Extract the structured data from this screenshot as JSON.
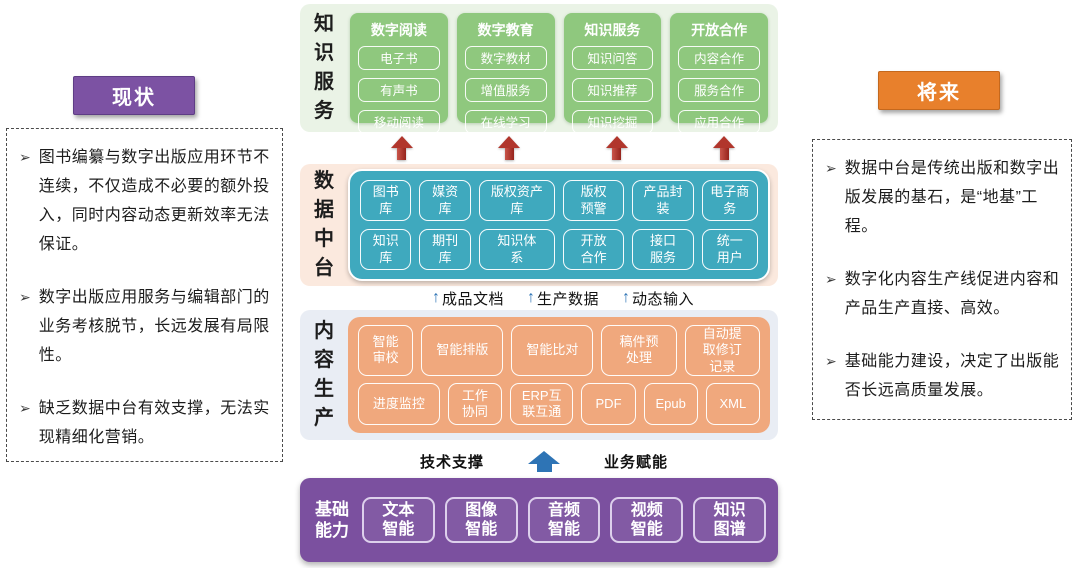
{
  "glyphs": {
    "bullet": "➢",
    "up_arrow": "↑"
  },
  "colors": {
    "status_purple": "#7c52a3",
    "future_orange": "#e8802c",
    "knowledge_green": "#8fc87e",
    "knowledge_bg": "#eaf3e6",
    "platform_teal": "#3fa9be",
    "platform_bg": "#fbe9de",
    "production_orange": "#f0a87d",
    "production_bg": "#e9edf4",
    "base_purple": "#7b509f",
    "arrow_red": "#b1362c",
    "arrow_blue": "#2e74b5"
  },
  "left_panel": {
    "title": "现状",
    "bullets": [
      "图书编纂与数字出版应用环节不连续，不仅造成不必要的额外投入，同时内容动态更新效率无法保证。",
      "数字出版应用服务与编辑部门的业务考核脱节，长远发展有局限性。",
      "缺乏数据中台有效支撑，无法实现精细化营销。"
    ]
  },
  "right_panel": {
    "title": "将来",
    "bullets": [
      "数据中台是传统出版和数字出版发展的基石，是“地基”工程。",
      "数字化内容生产线促进内容和产品生产直接、高效。",
      "基础能力建设，决定了出版能否长远高质量发展。"
    ]
  },
  "knowledge_service": {
    "label": "知识服务",
    "columns": [
      {
        "title": "数字阅读",
        "items": [
          "电子书",
          "有声书",
          "移动阅读"
        ]
      },
      {
        "title": "数字教育",
        "items": [
          "数字教材",
          "增值服务",
          "在线学习"
        ]
      },
      {
        "title": "知识服务",
        "items": [
          "知识问答",
          "知识推荐",
          "知识挖掘"
        ]
      },
      {
        "title": "开放合作",
        "items": [
          "内容合作",
          "服务合作",
          "应用合作"
        ]
      }
    ]
  },
  "data_platform": {
    "label": "数据中台",
    "rows": [
      [
        "图书库",
        "媒资库",
        "版权资产库",
        "版权预警",
        "产品封装",
        "电子商务"
      ],
      [
        "知识库",
        "期刊库",
        "知识体系",
        "开放合作",
        "接口服务",
        "统一用户"
      ]
    ]
  },
  "flow_labels": [
    "成品文档",
    "生产数据",
    "动态输入"
  ],
  "content_production": {
    "label": "内容生产",
    "rows": [
      [
        "智能审校",
        "智能排版",
        "智能比对",
        "稿件预处理",
        "自动提取修订记录"
      ],
      [
        "进度监控",
        "工作协同",
        "ERP互联互通",
        "PDF",
        "Epub",
        "XML"
      ]
    ]
  },
  "support_labels": {
    "left": "技术支撑",
    "right": "业务赋能"
  },
  "base_capability": {
    "label": "基础能力",
    "items": [
      "文本智能",
      "图像智能",
      "音频智能",
      "视频智能",
      "知识图谱"
    ]
  }
}
